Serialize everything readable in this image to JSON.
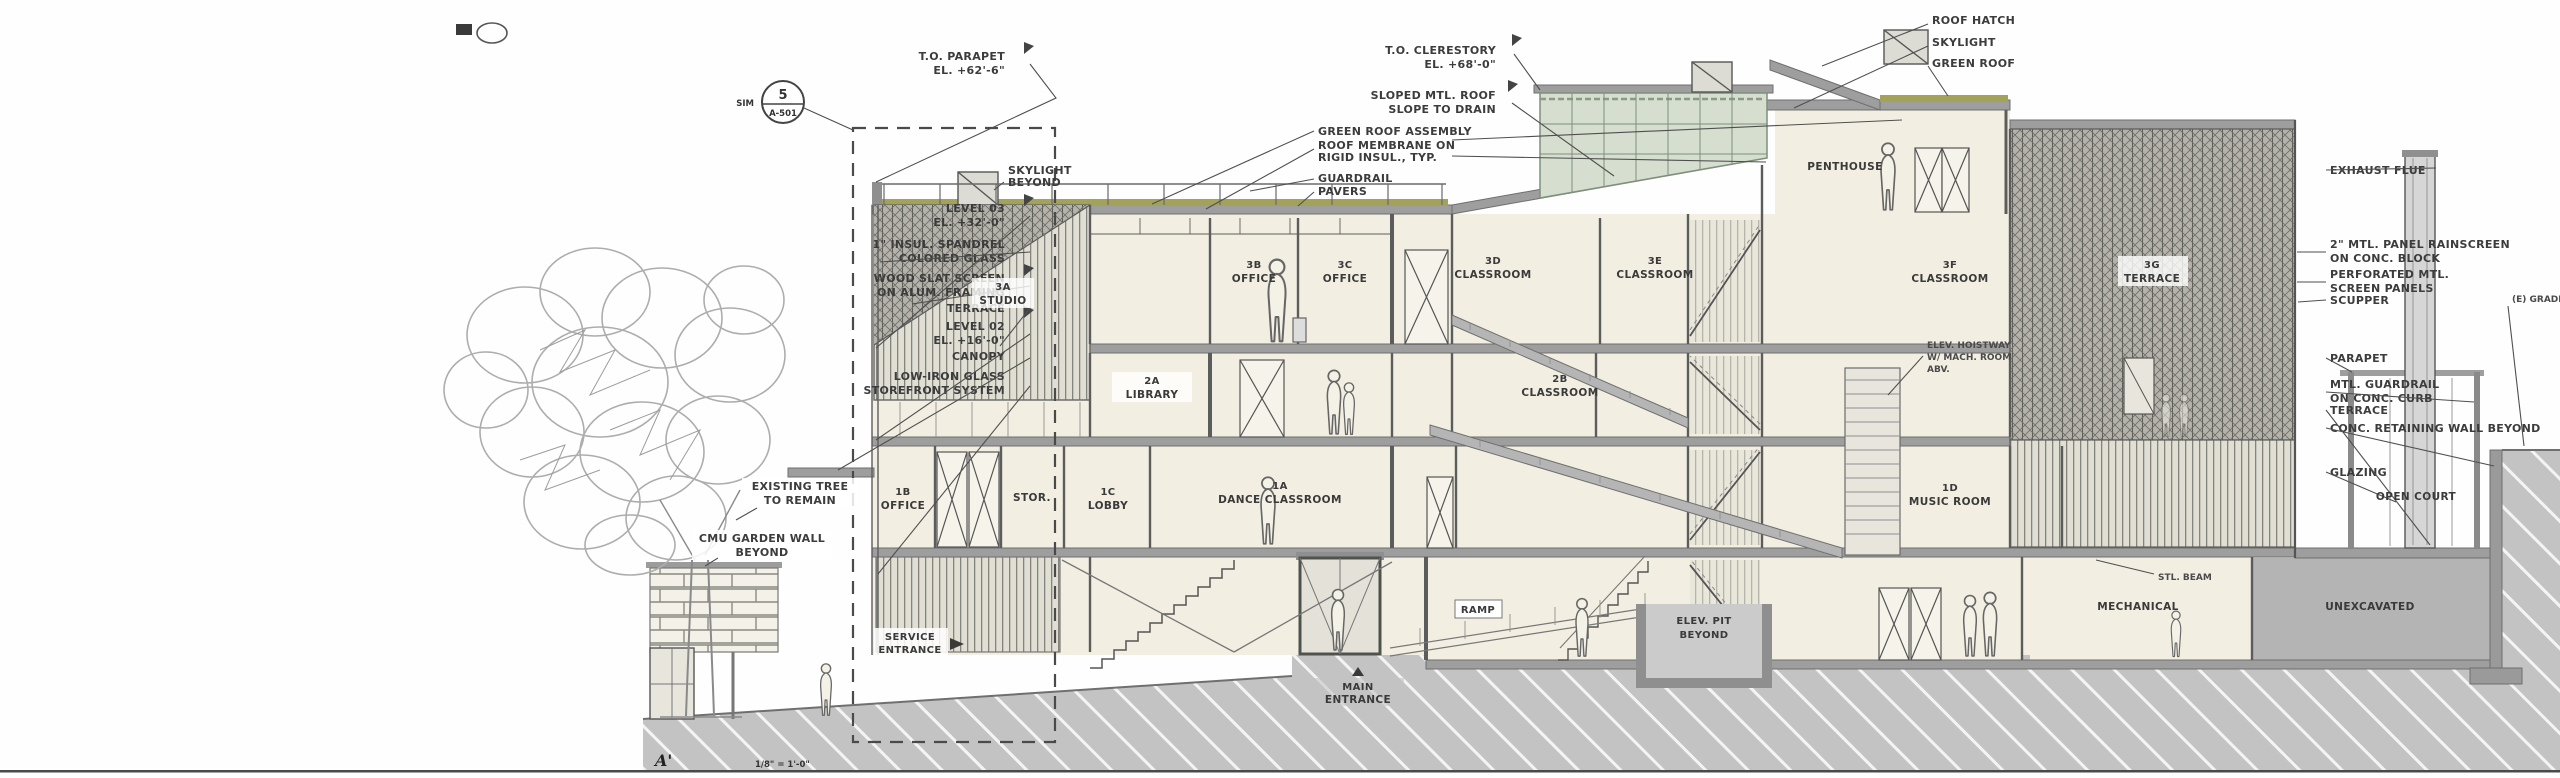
{
  "drawing": {
    "section_mark": "A'",
    "scale_note": "1/8\" = 1'-0\"",
    "key_bubble": {
      "number": "5",
      "sheet": "A-501",
      "suffix": "SIM"
    }
  },
  "colors": {
    "room_fill": "#f2efe2",
    "slab_gray": "#9e9e9e",
    "ground_poche": "#c3c3c3",
    "green_roof": "#a2a258",
    "clerestory_glass": "#d6decf",
    "annotation_text": "#3c3c3c"
  },
  "left_callouts": [
    {
      "line1": "T.O. PARAPET",
      "line2": "EL. +62'-6\""
    },
    {
      "line1": "LEVEL 03",
      "line2": "EL. +32'-0\""
    },
    {
      "line1": "1\" INSUL. SPANDREL",
      "line2": "COLORED GLASS"
    },
    {
      "line1": "WOOD SLAT SCREEN",
      "line2": "ON ALUM. FRAMING"
    },
    {
      "line1": "TERRACE"
    },
    {
      "line1": "LEVEL 02",
      "line2": "EL. +16'-0\""
    },
    {
      "line1": "CANOPY"
    },
    {
      "line1": "LOW-IRON GLASS",
      "line2": "STOREFRONT SYSTEM"
    },
    {
      "line1": "EXISTING TREE",
      "line2": "TO REMAIN"
    },
    {
      "line1": "CMU GARDEN WALL",
      "line2": "BEYOND"
    }
  ],
  "top_callouts": {
    "clerestory": {
      "line1": "T.O. CLERESTORY",
      "line2": "EL. +68'-0\""
    },
    "sloped_roof": {
      "line1": "SLOPED MTL. ROOF",
      "line2": "SLOPE TO DRAIN"
    },
    "roof_assembly": [
      "GREEN ROOF ASSEMBLY",
      "ROOF MEMBRANE ON",
      "RIGID INSUL., TYP.",
      "GUARDRAIL",
      "PAVERS"
    ],
    "skylight": {
      "line1": "SKYLIGHT",
      "line2": "BEYOND"
    },
    "right_trio": [
      "ROOF HATCH",
      "SKYLIGHT",
      "GREEN ROOF"
    ]
  },
  "interior_note": {
    "line1": "ELEV. HOISTWAY",
    "line2": "W/ MACH. ROOM",
    "line3": "ABV."
  },
  "right_callouts": [
    {
      "line1": "EXHAUST FLUE"
    },
    {
      "line1": "2\" MTL. PANEL RAINSCREEN",
      "line2": "ON CONC. BLOCK"
    },
    {
      "line1": "PERFORATED MTL.",
      "line2": "SCREEN PANELS"
    },
    {
      "line1": "SCUPPER"
    },
    {
      "line1": "PARAPET"
    },
    {
      "line1": "MTL. GUARDRAIL",
      "line2": "ON CONC. CURB"
    },
    {
      "line1": "TERRACE"
    },
    {
      "line1": "CONC. RETAINING WALL BEYOND"
    },
    {
      "line1": "GLAZING"
    },
    {
      "line1": "(E) GRADE"
    }
  ],
  "rooms": {
    "level3": [
      {
        "num": "3A",
        "name": "STUDIO"
      },
      {
        "num": "3B",
        "name": "OFFICE"
      },
      {
        "num": "3C",
        "name": "OFFICE"
      },
      {
        "num": "3D",
        "name": "CLASSROOM"
      },
      {
        "num": "3E",
        "name": "CLASSROOM"
      },
      {
        "num": "3F",
        "name": "CLASSROOM"
      },
      {
        "num": "3G",
        "name": "TERRACE"
      }
    ],
    "penthouse": {
      "name": "PENTHOUSE"
    },
    "level2": [
      {
        "num": "2A",
        "name": "LIBRARY"
      },
      {
        "num": "2B",
        "name": "CLASSROOM"
      }
    ],
    "level1": [
      {
        "num": "1B",
        "name": "OFFICE"
      },
      {
        "name": "STOR."
      },
      {
        "num": "1C",
        "name": "LOBBY"
      },
      {
        "num": "1A",
        "name": "DANCE CLASSROOM"
      },
      {
        "num": "1D",
        "name": "MUSIC ROOM"
      }
    ],
    "ground_ramp": {
      "name": "RAMP"
    },
    "basement": {
      "pit": {
        "line1": "ELEV. PIT",
        "line2": "BEYOND"
      },
      "mechanical": "MECHANICAL",
      "unexcavated": "UNEXCAVATED",
      "open_court": "OPEN COURT",
      "beam_note": "STL. BEAM"
    }
  },
  "site": {
    "main_entrance": {
      "line1": "MAIN",
      "line2": "ENTRANCE"
    },
    "service_entrance": {
      "line1": "SERVICE",
      "line2": "ENTRANCE"
    }
  }
}
